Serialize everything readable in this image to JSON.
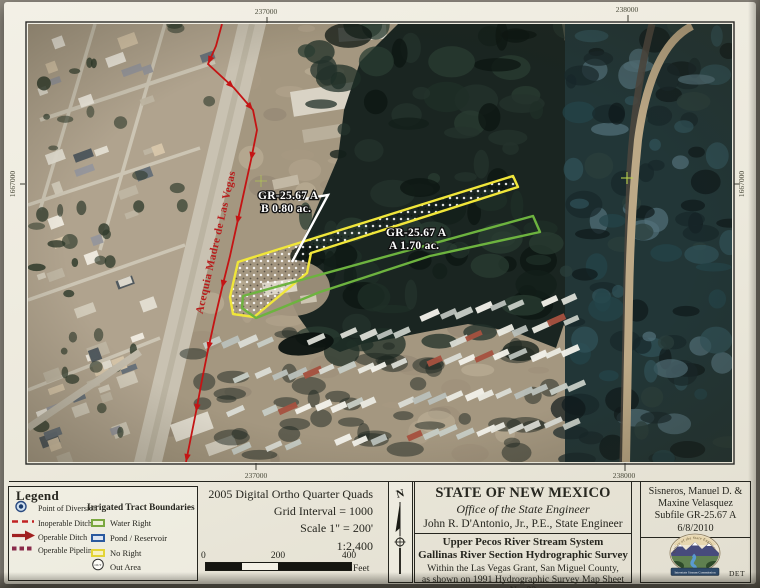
{
  "map": {
    "grid": {
      "top_labels": [
        "237000",
        "238000"
      ],
      "bottom_labels": [
        "237000",
        "238000"
      ],
      "left_label": "1667000",
      "right_label": "1667000"
    },
    "ditch_name": "Acequia Madre de Las Vegas",
    "tracts": [
      {
        "id": "GR-25.67 A",
        "area": "B  0.80 ac."
      },
      {
        "id": "GR-25.67 A",
        "area": "A  1.70 ac."
      }
    ]
  },
  "legend": {
    "title": "Legend",
    "items": [
      {
        "label": "Point of Diversion"
      },
      {
        "label": "Inoperable Ditch"
      },
      {
        "label": "Operable Ditch"
      },
      {
        "label": "Operable Pipeline"
      }
    ],
    "tract_boundaries": {
      "title": "Irrigated Tract Boundaries",
      "items": [
        {
          "label": "Water Right"
        },
        {
          "label": "Pond / Reservoir"
        },
        {
          "label": "No Right"
        },
        {
          "label": "Out Area",
          "badge": "OUT"
        }
      ]
    }
  },
  "scale_block": {
    "source": "2005 Digital Ortho Quarter Quads",
    "grid_interval": "Grid Interval = 1000",
    "scale": "Scale 1\" = 200'",
    "ratio": "1:2,400",
    "bar_ticks": [
      "0",
      "200",
      "400"
    ],
    "bar_unit": "Feet"
  },
  "north_arrow": {
    "label": "N"
  },
  "title_block": {
    "state": "STATE OF NEW MEXICO",
    "office": "Office of the State Engineer",
    "engineer": "John R. D'Antonio, Jr., P.E., State Engineer",
    "system1": "Upper Pecos River Stream System",
    "system2": "Gallinas River Section Hydrographic Survey",
    "note1": "Within the Las Vegas Grant, San Miguel County,",
    "note2": "as shown on 1991 Hydrographic Survey Map Sheet No. 23"
  },
  "subfile_block": {
    "owner_line1": "Sisneros, Manuel D. &",
    "owner_line2": "Maxine Velasquez",
    "subfile": "Subfile GR-25.67 A",
    "date": "6/8/2010",
    "seal_text": "Office of the State Engineer",
    "seal_banner": "Interstate Stream Commission",
    "code": "DET"
  },
  "colors": {
    "ditch_red": "#c41414",
    "no_right_yellow": "#f0e63a",
    "water_right_green": "#6db33f",
    "pond_blue": "#2a5a9f",
    "paper": "#efece0"
  }
}
